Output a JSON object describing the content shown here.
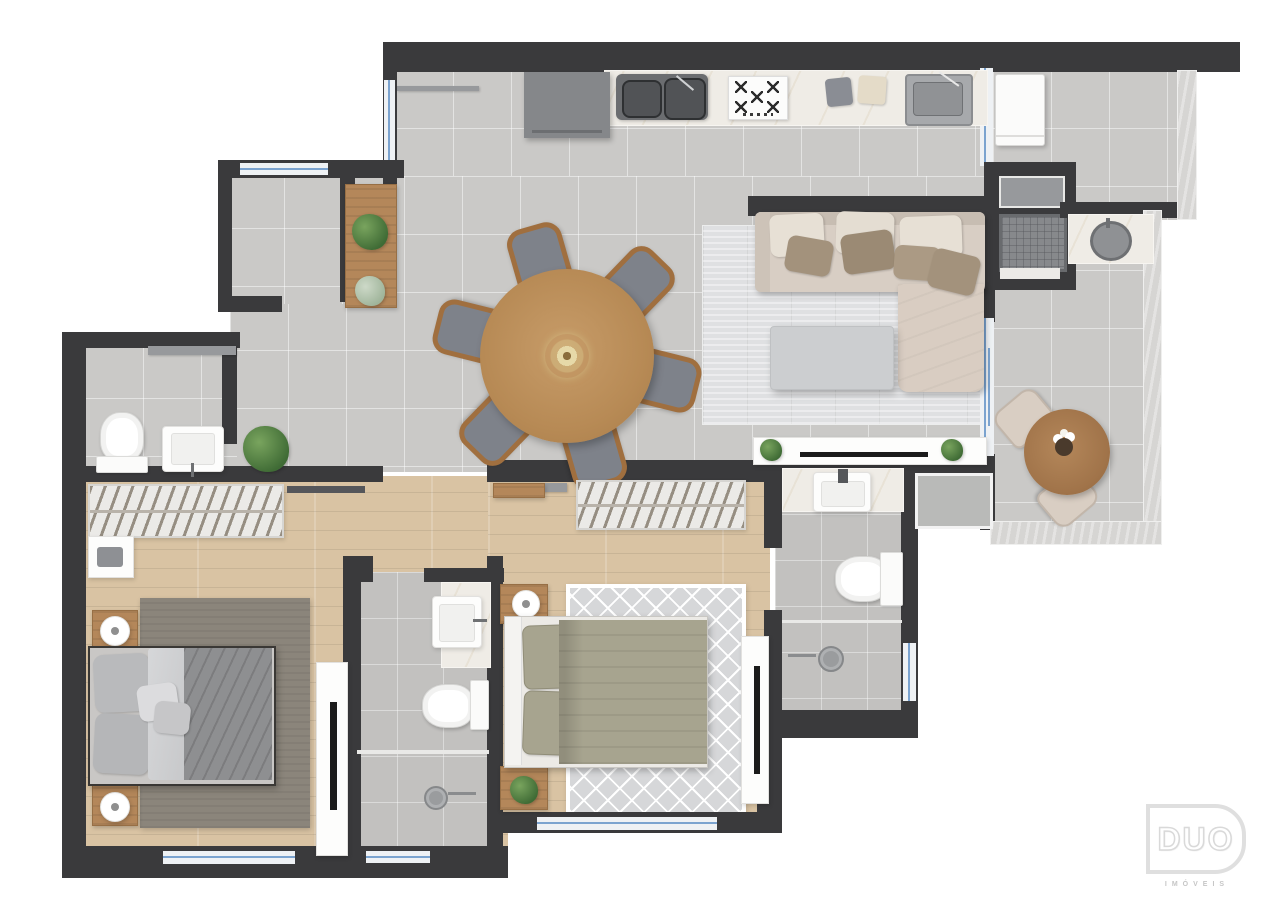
{
  "logo": {
    "brand": "DUO",
    "tagline": "IMÓVEIS"
  },
  "palette": {
    "wall": "#3a3a3c",
    "tile": "#cac9c7",
    "bath_tile": "#c2c1bf",
    "wood": "#d9c3a3",
    "marble": "#efece6",
    "glass": "#7ba3cf",
    "wood_furniture": "#b4875a",
    "sofa_beige": "#d8cec4",
    "bed_sage": "#a7a48f",
    "rug_dark": "#8b857b",
    "rug_light": "#dfe0e2",
    "greenery": "#3f6b35",
    "parapet": "#d6d5d3",
    "logo_gray": "#dfdfdf"
  },
  "elements": {
    "rooms": [
      "kitchen",
      "dining-living-room",
      "laundry-area",
      "gourmet-terrace",
      "entry-room",
      "powder-room",
      "master-bedroom",
      "hallway",
      "bathroom-1",
      "bedroom-2",
      "bathroom-2"
    ],
    "furniture": [
      "round-dining-table",
      "dining-chair",
      "sideboard",
      "l-shaped-sofa",
      "coffee-table",
      "tv-console",
      "bistro-table",
      "bistro-chair",
      "double-bed",
      "nightstand",
      "wardrobe",
      "tv-panel"
    ],
    "fixtures": [
      "double-kitchen-sink",
      "cooktop",
      "laundry-sink",
      "washing-machine",
      "barbecue-grill",
      "round-bbq-sink",
      "toilet",
      "vessel-sink",
      "bathroom-sink",
      "shower-drain",
      "window",
      "glass-door"
    ]
  }
}
